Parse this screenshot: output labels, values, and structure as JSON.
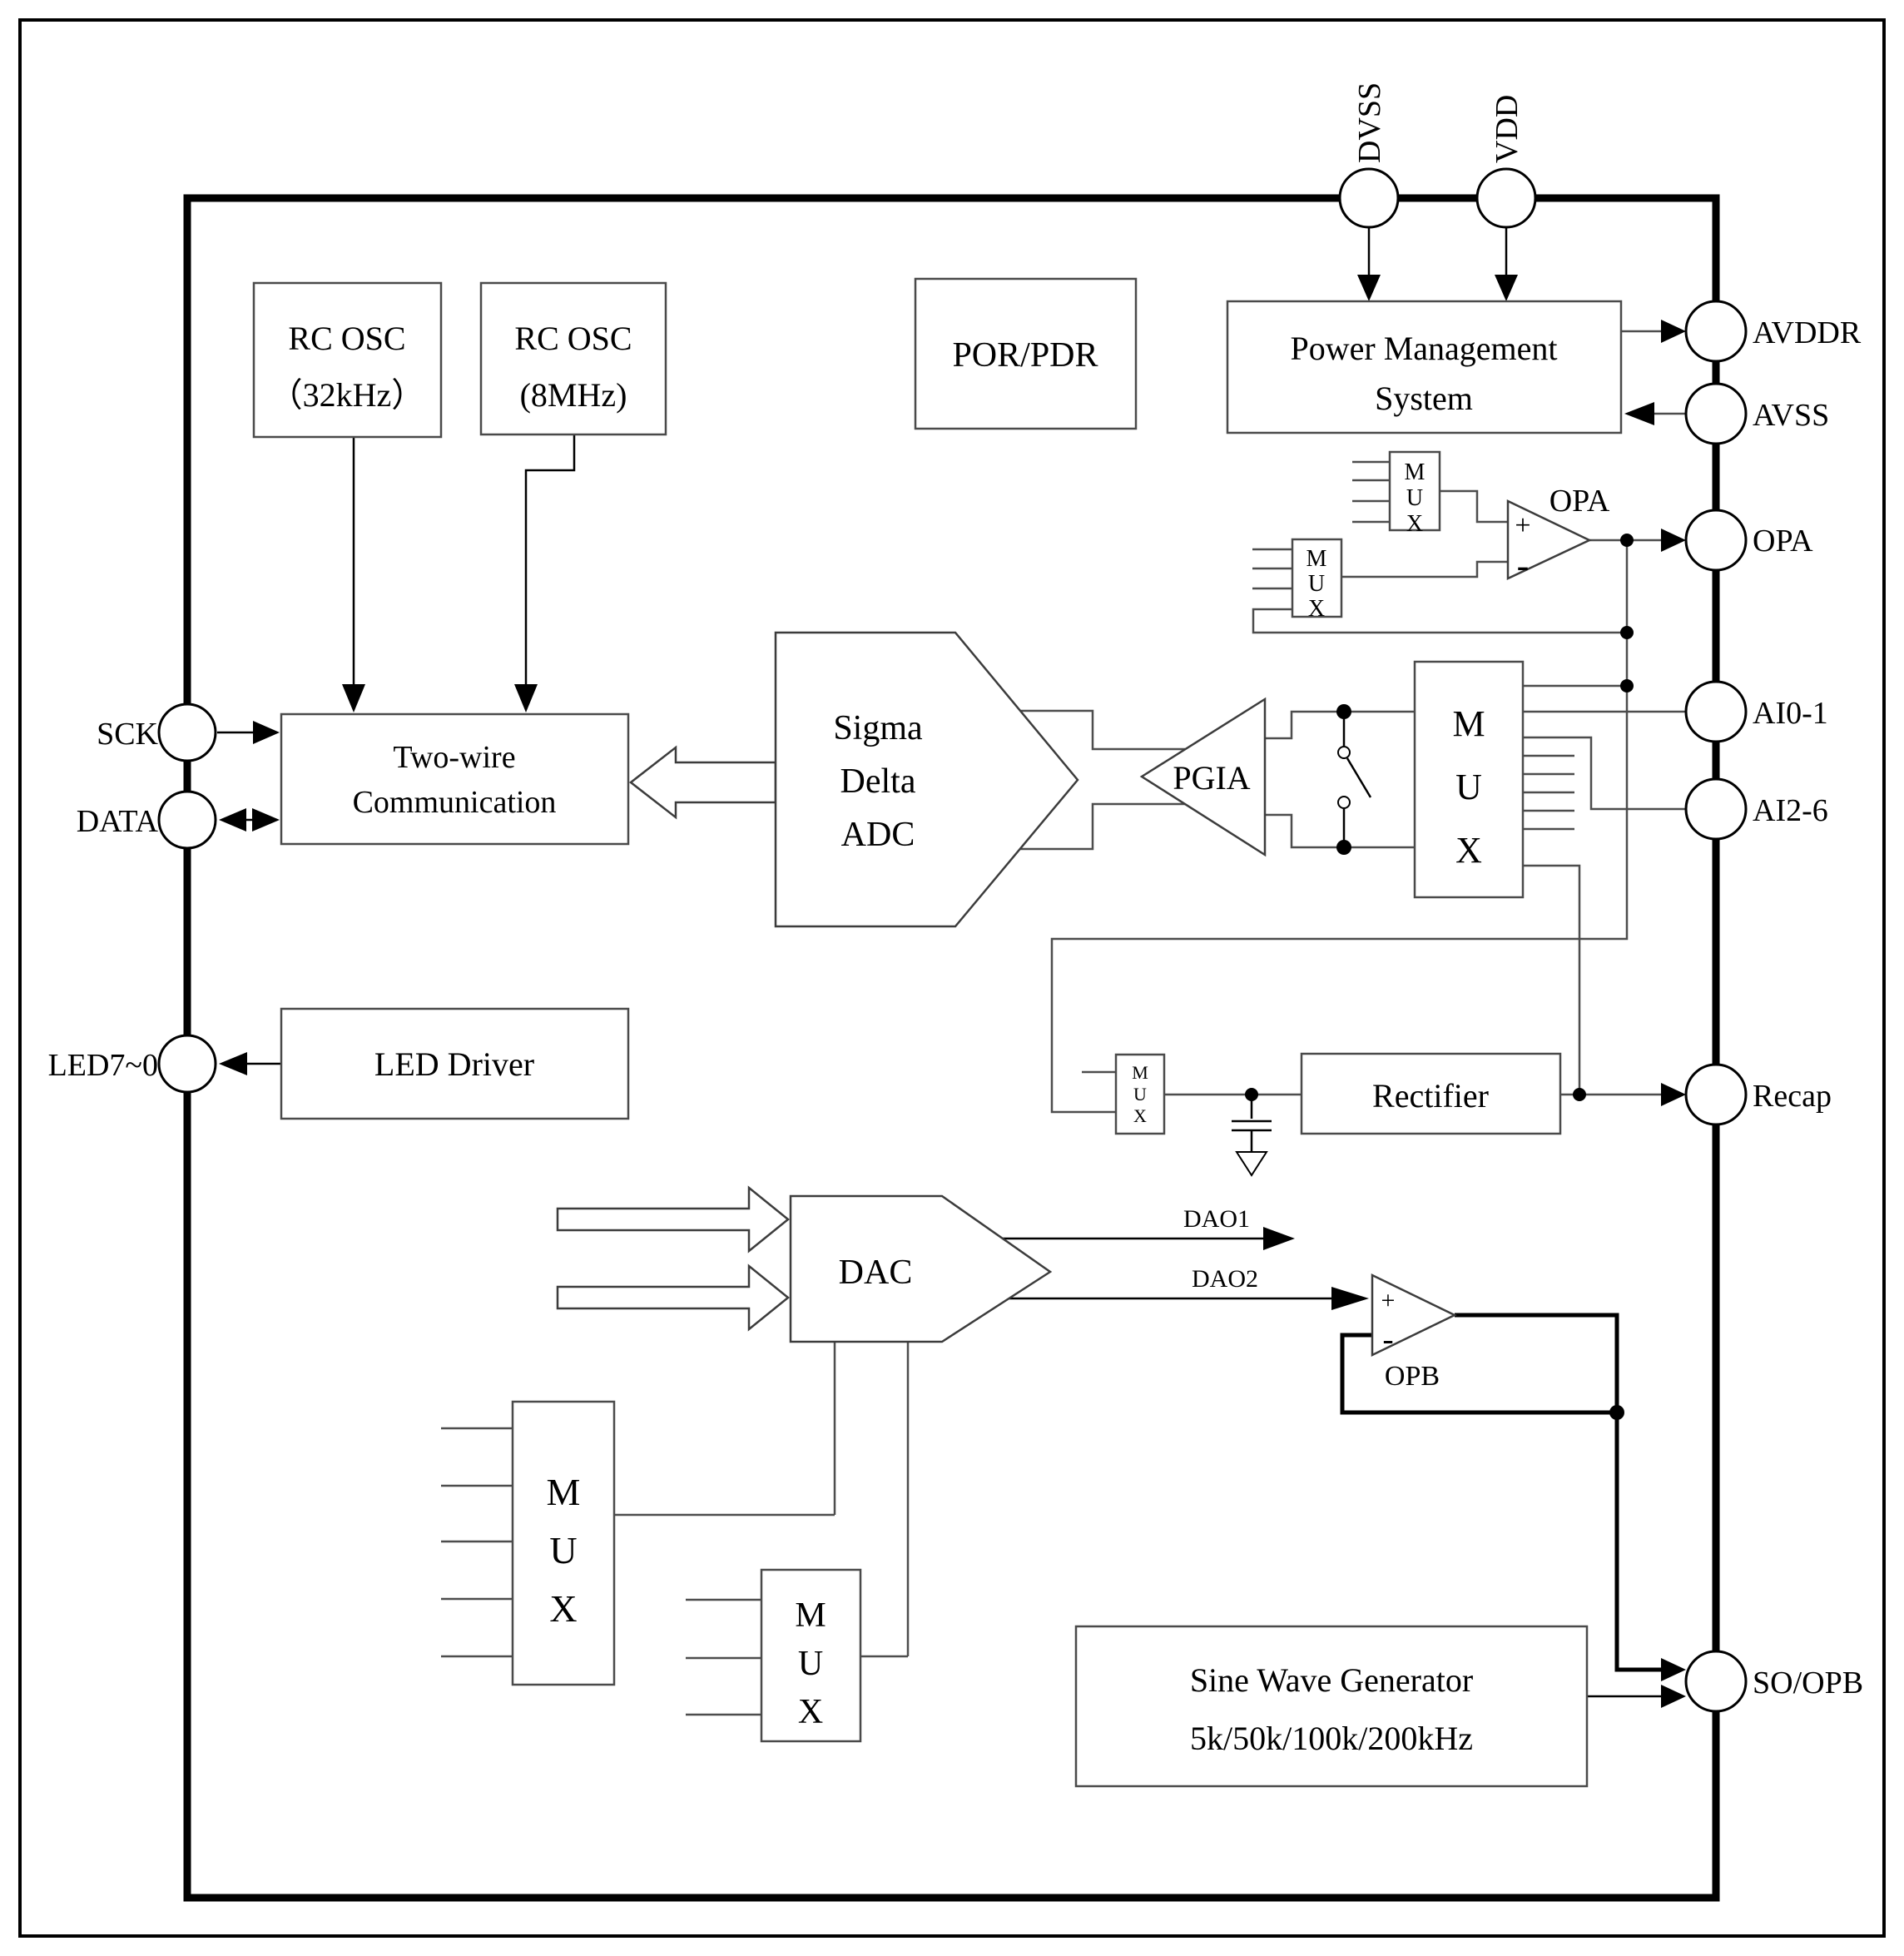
{
  "diagram": {
    "pins": {
      "dvss": "DVSS",
      "vdd": "VDD",
      "avddr": "AVDDR",
      "avss": "AVSS",
      "opa": "OPA",
      "ai01": "AI0-1",
      "ai26": "AI2-6",
      "recap": "Recap",
      "soopb": "SO/OPB",
      "sck": "SCK",
      "data": "DATA",
      "led": "LED7~0"
    },
    "blocks": {
      "rc32_l1": "RC OSC",
      "rc32_l2": "（32kHz）",
      "rc8_l1": "RC OSC",
      "rc8_l2": "(8MHz)",
      "porpdr": "POR/PDR",
      "pms_l1": "Power Management",
      "pms_l2": "System",
      "twc_l1": "Two-wire",
      "twc_l2": "Communication",
      "adc_l1": "Sigma",
      "adc_l2": "Delta",
      "adc_l3": "ADC",
      "pgia": "PGIA",
      "led_driver": "LED Driver",
      "rectifier": "Rectifier",
      "dac": "DAC",
      "swg_l1": "Sine Wave Generator",
      "swg_l2": "5k/50k/100k/200kHz",
      "opa_amp": "OPA",
      "opb_amp": "OPB",
      "mux_m": "M",
      "mux_u": "U",
      "mux_x": "X",
      "plus": "+",
      "minus": "-"
    },
    "signals": {
      "dao1": "DAO1",
      "dao2": "DAO2"
    },
    "colors": {
      "ink": "#000000",
      "background": "#ffffff"
    }
  }
}
